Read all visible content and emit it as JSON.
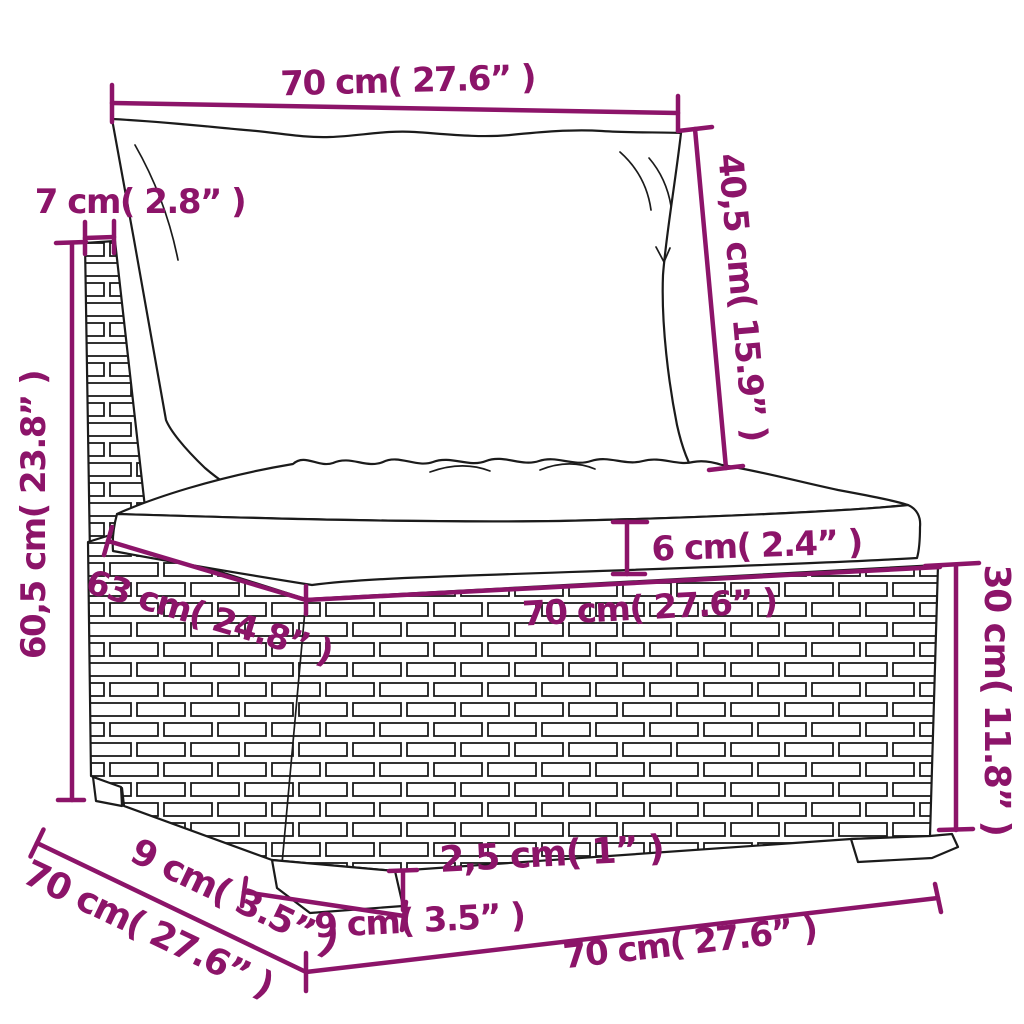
{
  "canvas": {
    "width": 1024,
    "height": 1024,
    "background": "#ffffff"
  },
  "style": {
    "dimension_color": "#8C1469",
    "outline_color": "#1b1b1b",
    "fill_color": "#ffffff"
  },
  "dimensions": {
    "back_cushion_width": {
      "label": "70 cm( 27.6” )",
      "value_cm": 70,
      "value_in": 27.6
    },
    "back_panel_thickness": {
      "label": "7 cm( 2.8” )",
      "value_cm": 7,
      "value_in": 2.8
    },
    "back_cushion_height": {
      "label": "40,5 cm( 15.9” )",
      "value_cm": 40.5,
      "value_in": 15.9
    },
    "total_height": {
      "label": "60,5 cm( 23.8” )",
      "value_cm": 60.5,
      "value_in": 23.8
    },
    "seat_cushion_thickness": {
      "label": "6 cm( 2.4” )",
      "value_cm": 6,
      "value_in": 2.4
    },
    "seat_depth": {
      "label": "63 cm( 24.8” )",
      "value_cm": 63,
      "value_in": 24.8
    },
    "seat_width": {
      "label": "70 cm( 27.6” )",
      "value_cm": 70,
      "value_in": 27.6
    },
    "base_height": {
      "label": "30 cm( 11.8” )",
      "value_cm": 30,
      "value_in": 11.8
    },
    "leg_height": {
      "label": "2,5 cm( 1” )",
      "value_cm": 2.5,
      "value_in": 1
    },
    "leg_width_front": {
      "label": "9 cm( 3.5” )",
      "value_cm": 9,
      "value_in": 3.5
    },
    "leg_width_side": {
      "label": "9 cm( 3.5” )",
      "value_cm": 9,
      "value_in": 3.5
    },
    "bottom_depth": {
      "label": "70 cm( 27.6” )",
      "value_cm": 70,
      "value_in": 27.6
    },
    "bottom_width": {
      "label": "70 cm( 27.6” )",
      "value_cm": 70,
      "value_in": 27.6
    }
  }
}
